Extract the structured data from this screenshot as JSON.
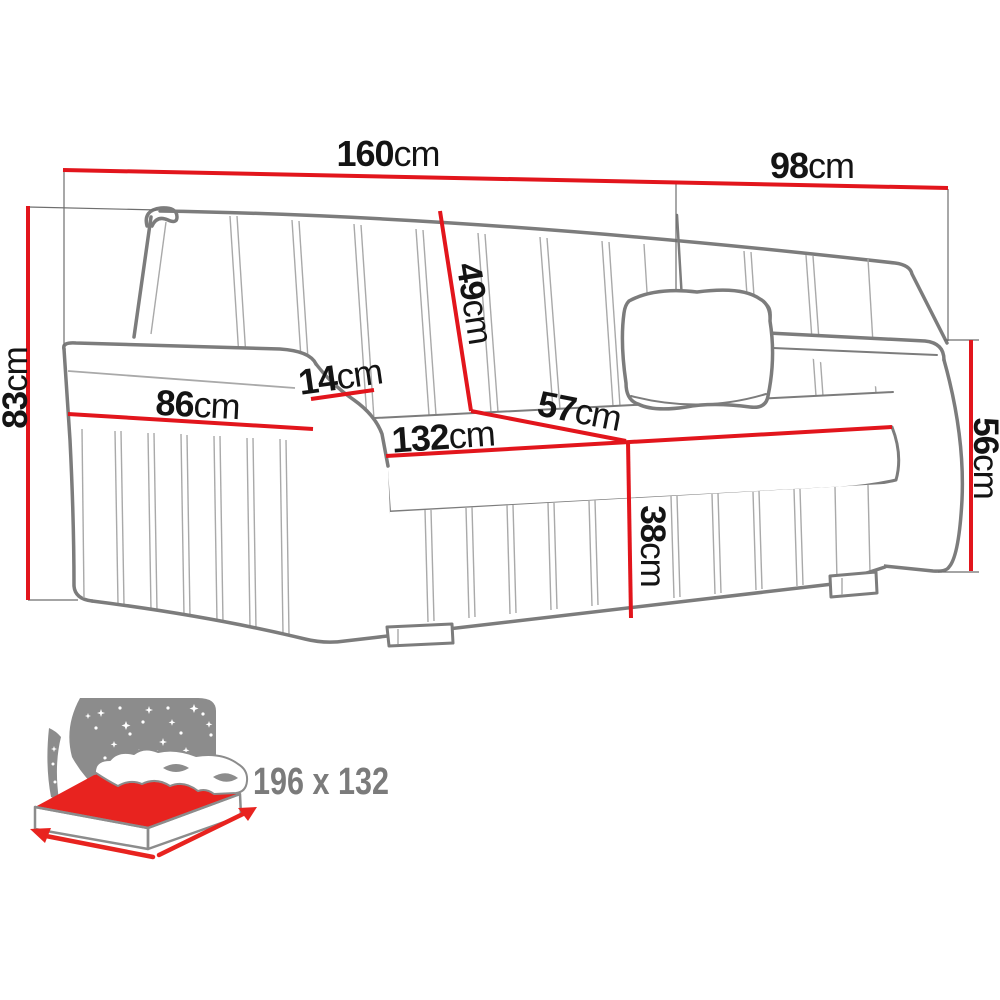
{
  "dimensions": {
    "total_width": {
      "value": "160",
      "unit": "cm"
    },
    "total_depth": {
      "value": "98",
      "unit": "cm"
    },
    "total_height": {
      "value": "83",
      "unit": "cm"
    },
    "backrest_height": {
      "value": "49",
      "unit": "cm"
    },
    "armrest_top_width": {
      "value": "14",
      "unit": "cm"
    },
    "armrest_length": {
      "value": "86",
      "unit": "cm"
    },
    "seat_depth": {
      "value": "57",
      "unit": "cm"
    },
    "seat_width": {
      "value": "132",
      "unit": "cm"
    },
    "seat_height": {
      "value": "38",
      "unit": "cm"
    },
    "armrest_height": {
      "value": "56",
      "unit": "cm"
    }
  },
  "sleeping_area": {
    "size": "196 x 132"
  },
  "colors": {
    "dimension_line_red": "#e2151c",
    "sofa_outline_gray": "#7c7c7c",
    "seam_gray": "#a9a9a9",
    "extension_gray": "#6e6e6e",
    "label_black": "#141414",
    "icon_gray": "#8c8c8c",
    "icon_red": "#e8231f",
    "size_text_gray": "#7b7b7b",
    "background": "#ffffff"
  }
}
